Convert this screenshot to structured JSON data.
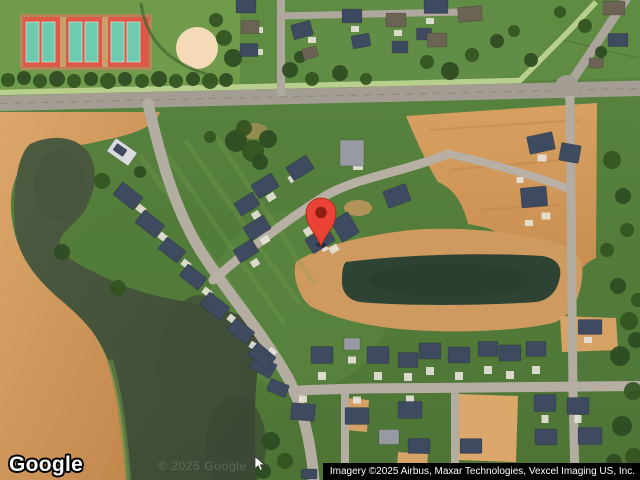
{
  "map": {
    "provider_logo": "Google",
    "watermark": "© 2025 Google",
    "attribution": "Imagery ©2025 Airbus, Maxar Technologies, Vexcel Imaging US, Inc.",
    "pin": {
      "x": 321,
      "y": 246,
      "color": "#EA4335",
      "inner_color": "#8E1D12"
    }
  },
  "scene": {
    "colors": {
      "grass": "#55803b",
      "grass_light": "#6b9849",
      "dirt": "#cf975c",
      "water": "#47553d",
      "pond": "#2e4334",
      "road": "#b2aaa0",
      "roof_dark": "#3e4a60",
      "roof_light": "#979ba1",
      "roof_brown": "#6b6354",
      "roof_white": "#d9dbdd",
      "tree": "#2e4b22",
      "tree_alt": "#33541f",
      "pad": "#e6e2d8",
      "tennis_red": "#dd5847",
      "tennis_court": "#6fcbaf",
      "baseball": "#f4dab6",
      "pin": "#EA4335",
      "pin_inner": "#8E1D12"
    },
    "houses": [
      [
        246,
        6,
        20,
        14,
        0,
        0
      ],
      [
        250,
        27,
        18,
        13,
        0,
        2
      ],
      [
        249,
        50,
        18,
        13,
        0,
        0
      ],
      [
        302,
        30,
        20,
        15,
        -15,
        0
      ],
      [
        310,
        53,
        15,
        11,
        -15,
        2
      ],
      [
        352,
        16,
        20,
        14,
        0,
        0
      ],
      [
        361,
        41,
        18,
        13,
        -10,
        0
      ],
      [
        396,
        20,
        20,
        14,
        0,
        2
      ],
      [
        400,
        47,
        16,
        12,
        0,
        0
      ],
      [
        424,
        34,
        15,
        12,
        0,
        0
      ],
      [
        436,
        6,
        24,
        15,
        0,
        0
      ],
      [
        470,
        14,
        24,
        15,
        -5,
        2
      ],
      [
        437,
        40,
        20,
        14,
        0,
        2
      ],
      [
        614,
        8,
        22,
        14,
        0,
        2
      ],
      [
        618,
        40,
        20,
        13,
        0,
        0
      ],
      [
        596,
        63,
        14,
        10,
        0,
        2
      ],
      [
        122,
        152,
        26,
        16,
        35,
        3
      ],
      [
        120,
        150,
        12,
        8,
        35,
        0
      ],
      [
        128,
        196,
        26,
        16,
        38,
        0
      ],
      [
        150,
        224,
        26,
        16,
        38,
        0
      ],
      [
        172,
        250,
        24,
        15,
        38,
        0
      ],
      [
        193,
        277,
        24,
        15,
        38,
        0
      ],
      [
        215,
        306,
        26,
        16,
        38,
        0
      ],
      [
        241,
        331,
        24,
        15,
        38,
        0
      ],
      [
        263,
        366,
        24,
        16,
        30,
        0
      ],
      [
        278,
        388,
        20,
        13,
        22,
        0
      ],
      [
        300,
        168,
        24,
        16,
        -32,
        0
      ],
      [
        265,
        186,
        24,
        16,
        -32,
        0
      ],
      [
        247,
        204,
        22,
        15,
        -32,
        0
      ],
      [
        257,
        228,
        24,
        16,
        -32,
        0
      ],
      [
        246,
        251,
        22,
        15,
        -32,
        0
      ],
      [
        345,
        227,
        20,
        24,
        -30,
        0
      ],
      [
        320,
        240,
        26,
        17,
        -32,
        0
      ],
      [
        352,
        153,
        24,
        26,
        0,
        1
      ],
      [
        397,
        196,
        24,
        18,
        -20,
        0
      ],
      [
        541,
        143,
        26,
        18,
        -12,
        0
      ],
      [
        570,
        153,
        20,
        18,
        10,
        0
      ],
      [
        534,
        197,
        26,
        20,
        -5,
        0
      ],
      [
        262,
        356,
        24,
        16,
        40,
        0
      ],
      [
        322,
        355,
        22,
        17,
        0,
        0
      ],
      [
        352,
        344,
        16,
        12,
        0,
        1
      ],
      [
        378,
        355,
        22,
        17,
        0,
        0
      ],
      [
        408,
        360,
        20,
        15,
        0,
        0
      ],
      [
        430,
        351,
        22,
        16,
        0,
        0
      ],
      [
        459,
        355,
        22,
        16,
        0,
        0
      ],
      [
        488,
        349,
        20,
        15,
        0,
        0
      ],
      [
        510,
        353,
        22,
        16,
        0,
        0
      ],
      [
        536,
        349,
        20,
        15,
        0,
        0
      ],
      [
        590,
        327,
        24,
        15,
        0,
        0
      ],
      [
        303,
        412,
        24,
        17,
        5,
        0
      ],
      [
        357,
        416,
        24,
        17,
        0,
        0
      ],
      [
        410,
        410,
        24,
        17,
        0,
        0
      ],
      [
        389,
        437,
        20,
        15,
        0,
        1
      ],
      [
        419,
        446,
        22,
        15,
        0,
        0
      ],
      [
        471,
        446,
        22,
        15,
        0,
        0
      ],
      [
        545,
        403,
        22,
        17,
        0,
        0
      ],
      [
        546,
        437,
        22,
        16,
        0,
        0
      ],
      [
        578,
        406,
        22,
        17,
        0,
        0
      ],
      [
        590,
        436,
        24,
        17,
        0,
        0
      ],
      [
        338,
        473,
        22,
        12,
        0,
        0
      ],
      [
        309,
        474,
        16,
        10,
        0,
        0
      ],
      [
        424,
        478,
        18,
        8,
        0,
        0
      ],
      [
        540,
        474,
        20,
        10,
        0,
        0
      ],
      [
        600,
        470,
        20,
        12,
        0,
        0
      ]
    ],
    "pads": [
      [
        141,
        209,
        9,
        7,
        38
      ],
      [
        163,
        237,
        9,
        7,
        38
      ],
      [
        186,
        264,
        9,
        7,
        38
      ],
      [
        207,
        292,
        9,
        7,
        38
      ],
      [
        232,
        319,
        9,
        7,
        38
      ],
      [
        254,
        346,
        9,
        7,
        30
      ],
      [
        293,
        178,
        9,
        7,
        -32
      ],
      [
        271,
        197,
        9,
        7,
        -32
      ],
      [
        256,
        215,
        8,
        7,
        -32
      ],
      [
        265,
        240,
        9,
        7,
        -32
      ],
      [
        255,
        263,
        8,
        7,
        -32
      ],
      [
        309,
        231,
        10,
        8,
        -32
      ],
      [
        325,
        249,
        6,
        4,
        -30
      ],
      [
        334,
        249,
        9,
        7,
        -32
      ],
      [
        358,
        166,
        10,
        8,
        0
      ],
      [
        322,
        376,
        8,
        8,
        0
      ],
      [
        378,
        376,
        8,
        8,
        0
      ],
      [
        408,
        377,
        8,
        8,
        0
      ],
      [
        430,
        371,
        8,
        8,
        0
      ],
      [
        459,
        376,
        8,
        8,
        0
      ],
      [
        488,
        370,
        8,
        8,
        0
      ],
      [
        510,
        375,
        8,
        8,
        0
      ],
      [
        536,
        370,
        8,
        8,
        0
      ],
      [
        352,
        360,
        8,
        7,
        0
      ],
      [
        303,
        399,
        8,
        7,
        0
      ],
      [
        357,
        400,
        8,
        7,
        0
      ],
      [
        410,
        399,
        8,
        7,
        0
      ],
      [
        545,
        419,
        8,
        7,
        90
      ],
      [
        578,
        419,
        8,
        7,
        90
      ],
      [
        259,
        30,
        8,
        6,
        0
      ],
      [
        259,
        52,
        8,
        6,
        0
      ],
      [
        312,
        40,
        8,
        6,
        0
      ],
      [
        355,
        29,
        8,
        6,
        0
      ],
      [
        398,
        33,
        8,
        6,
        0
      ],
      [
        430,
        21,
        8,
        6,
        0
      ],
      [
        542,
        158,
        9,
        7,
        0
      ],
      [
        546,
        216,
        9,
        7,
        0
      ],
      [
        529,
        223,
        8,
        6,
        0
      ],
      [
        520,
        180,
        7,
        6,
        0
      ],
      [
        272,
        352,
        8,
        7,
        40
      ],
      [
        588,
        340,
        8,
        6,
        0
      ]
    ],
    "trees": [
      [
        8,
        80,
        7
      ],
      [
        24,
        78,
        7
      ],
      [
        40,
        81,
        7
      ],
      [
        57,
        79,
        8
      ],
      [
        74,
        81,
        7
      ],
      [
        91,
        79,
        7
      ],
      [
        108,
        81,
        8
      ],
      [
        125,
        79,
        7
      ],
      [
        142,
        81,
        7
      ],
      [
        159,
        79,
        8
      ],
      [
        176,
        81,
        7
      ],
      [
        193,
        79,
        7
      ],
      [
        210,
        81,
        8
      ],
      [
        226,
        80,
        7
      ],
      [
        224,
        38,
        8
      ],
      [
        233,
        58,
        9
      ],
      [
        216,
        20,
        7
      ],
      [
        290,
        70,
        8
      ],
      [
        312,
        79,
        7
      ],
      [
        340,
        73,
        8
      ],
      [
        366,
        79,
        6
      ],
      [
        300,
        57,
        6
      ],
      [
        427,
        62,
        7
      ],
      [
        450,
        71,
        9
      ],
      [
        472,
        55,
        7
      ],
      [
        497,
        41,
        7
      ],
      [
        514,
        31,
        6
      ],
      [
        531,
        60,
        7
      ],
      [
        585,
        26,
        7
      ],
      [
        601,
        52,
        6
      ],
      [
        560,
        12,
        6
      ],
      [
        236,
        141,
        11
      ],
      [
        253,
        151,
        11
      ],
      [
        268,
        139,
        9
      ],
      [
        244,
        128,
        8
      ],
      [
        260,
        162,
        8
      ],
      [
        102,
        181,
        8
      ],
      [
        62,
        252,
        8
      ],
      [
        118,
        288,
        8
      ],
      [
        140,
        172,
        6
      ],
      [
        612,
        160,
        9
      ],
      [
        623,
        196,
        8
      ],
      [
        607,
        250,
        7
      ],
      [
        618,
        286,
        8
      ],
      [
        629,
        321,
        9
      ],
      [
        620,
        356,
        10
      ],
      [
        633,
        391,
        9
      ],
      [
        622,
        426,
        10
      ],
      [
        634,
        457,
        9
      ],
      [
        614,
        462,
        8
      ],
      [
        638,
        300,
        7
      ],
      [
        636,
        340,
        8
      ],
      [
        627,
        230,
        7
      ],
      [
        271,
        441,
        9
      ],
      [
        285,
        461,
        8
      ],
      [
        263,
        471,
        8
      ],
      [
        210,
        137,
        6
      ]
    ]
  }
}
